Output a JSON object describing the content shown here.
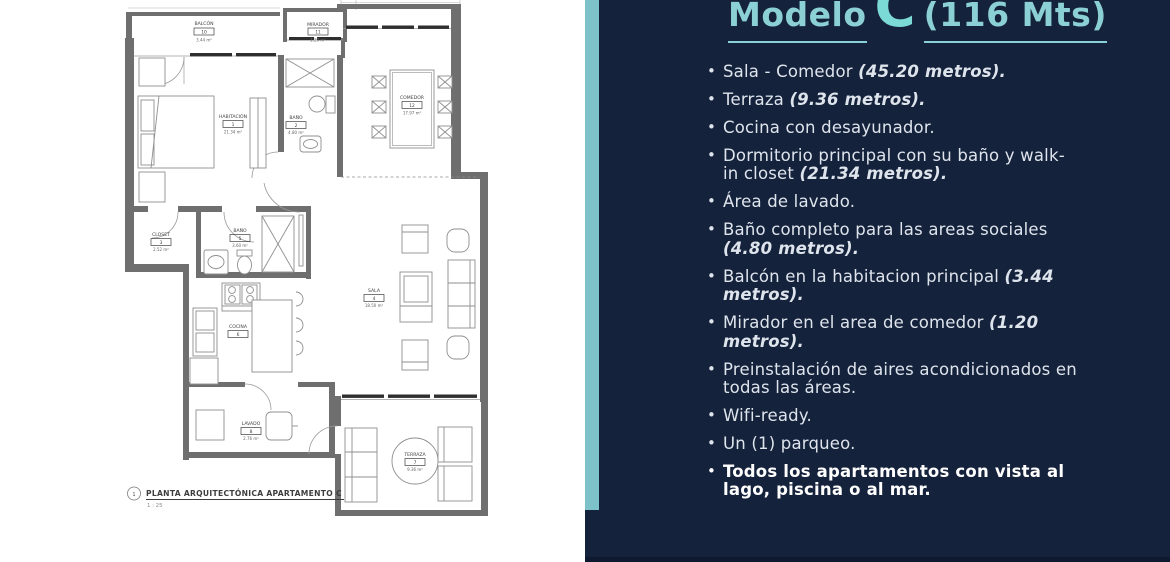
{
  "title": {
    "modelo": "Modelo",
    "letter": "C",
    "size": "(116 Mts)"
  },
  "panel": {
    "items": [
      {
        "text": "Sala - Comedor ",
        "em": "(45.20 metros)."
      },
      {
        "text": "Terraza ",
        "em": "(9.36 metros)."
      },
      {
        "text": "Cocina con desayunador.",
        "em": ""
      },
      {
        "text": "Dormitorio principal con su baño y walk-in closet ",
        "em": "(21.34 metros)."
      },
      {
        "text": "Área de lavado.",
        "em": ""
      },
      {
        "text": "Baño completo para las areas sociales ",
        "em": "(4.80 metros)."
      },
      {
        "text": "Balcón en la habitacion principal ",
        "em": "(3.44 metros)."
      },
      {
        "text": "Mirador en el area de comedor ",
        "em": "(1.20 metros)."
      },
      {
        "text": "Preinstalación de aires acondicionados en todas las áreas.",
        "em": ""
      },
      {
        "text": "Wifi-ready.",
        "em": ""
      },
      {
        "text": "Un (1) parqueo.",
        "em": ""
      },
      {
        "text": "Todos los apartamentos con vista al lago, piscina o al mar.",
        "em": ""
      }
    ]
  },
  "colors": {
    "navy": "#15223C",
    "teal": "#7CC2C8",
    "title_teal": "#8BD0D4"
  },
  "plan": {
    "caption": "PLANTA ARQUITECTÓNICA APARTAMENTO C",
    "scale": "1 : 25",
    "number": "1",
    "rooms": [
      {
        "name": "BALCÓN",
        "number": "10",
        "area": "3.44 m²"
      },
      {
        "name": "MIRADOR",
        "number": "11",
        "area": "1.20 m²"
      },
      {
        "name": "COMEDOR",
        "number": "12",
        "area": "17.97 m²"
      },
      {
        "name": "HABITACIÓN",
        "number": "1",
        "area": "21.34 m²"
      },
      {
        "name": "BAÑO",
        "number": "2",
        "area": "4.80 m²"
      },
      {
        "name": "CLOSET",
        "number": "3",
        "area": "2.52 m²"
      },
      {
        "name": "BAÑO",
        "number": "5",
        "area": "3.60 m²"
      },
      {
        "name": "COCINA",
        "number": "6",
        "area": ""
      },
      {
        "name": "SALA",
        "number": "4",
        "area": "18.50 m²"
      },
      {
        "name": "LAVADO",
        "number": "8",
        "area": "2.76 m²"
      },
      {
        "name": "TERRAZA",
        "number": "7",
        "area": "9.36 m²"
      }
    ]
  }
}
